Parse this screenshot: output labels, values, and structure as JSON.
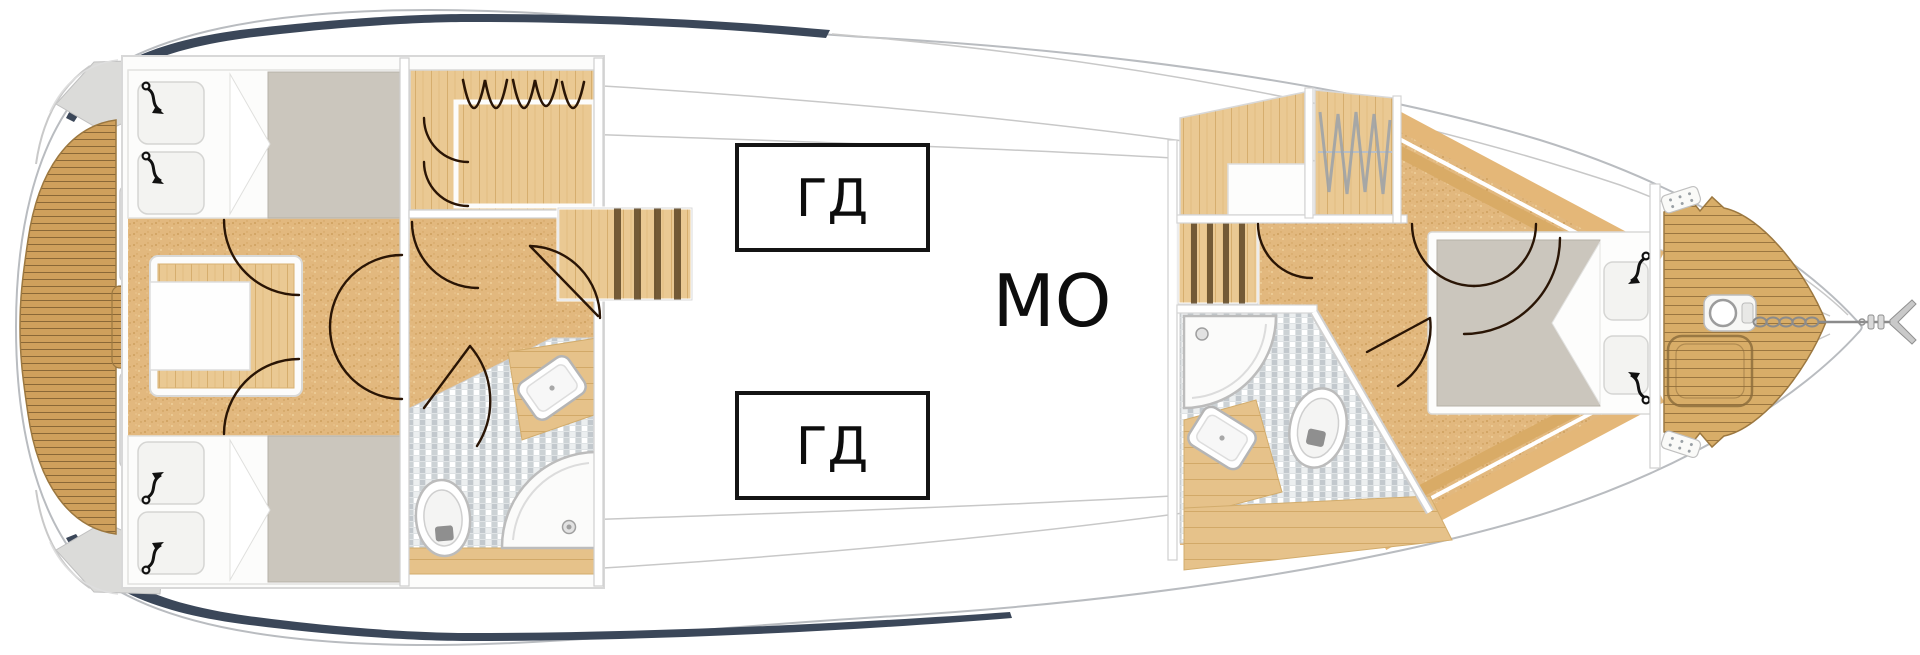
{
  "plan": {
    "engine_box_1": "ГД",
    "engine_box_2": "ГД",
    "engine_room_label": "МО"
  },
  "colors": {
    "hull_accent": "#3b4759",
    "hull_line": "#b9bcc0",
    "teak": "#cfa05c",
    "teak_line": "#7c5c2e",
    "wood_floor": "#eac993",
    "carpet": "#e2b87e",
    "mosaic": "#dfe3e5",
    "mattress": "#cbc6bd",
    "door_arc": "#2a1505",
    "engine_box_border": "#141414"
  },
  "icons": [
    "reading-light-icon",
    "clothes-hanger-icon",
    "hanger-rail-icon",
    "stairs",
    "toilet-icon",
    "sink-icon",
    "corner-shower-icon",
    "drain-icon",
    "windlass-icon",
    "anchor-chain-icon",
    "anchor-icon",
    "cleat-icon",
    "sunpad-outline"
  ],
  "rooms": [
    "swim-platform",
    "aft-cabin",
    "wardrobe-aft",
    "bathroom-aft",
    "corridor",
    "engine-room",
    "head-forward",
    "wardrobe-forward",
    "bathroom-forward",
    "vip-cabin",
    "bow-deck"
  ]
}
